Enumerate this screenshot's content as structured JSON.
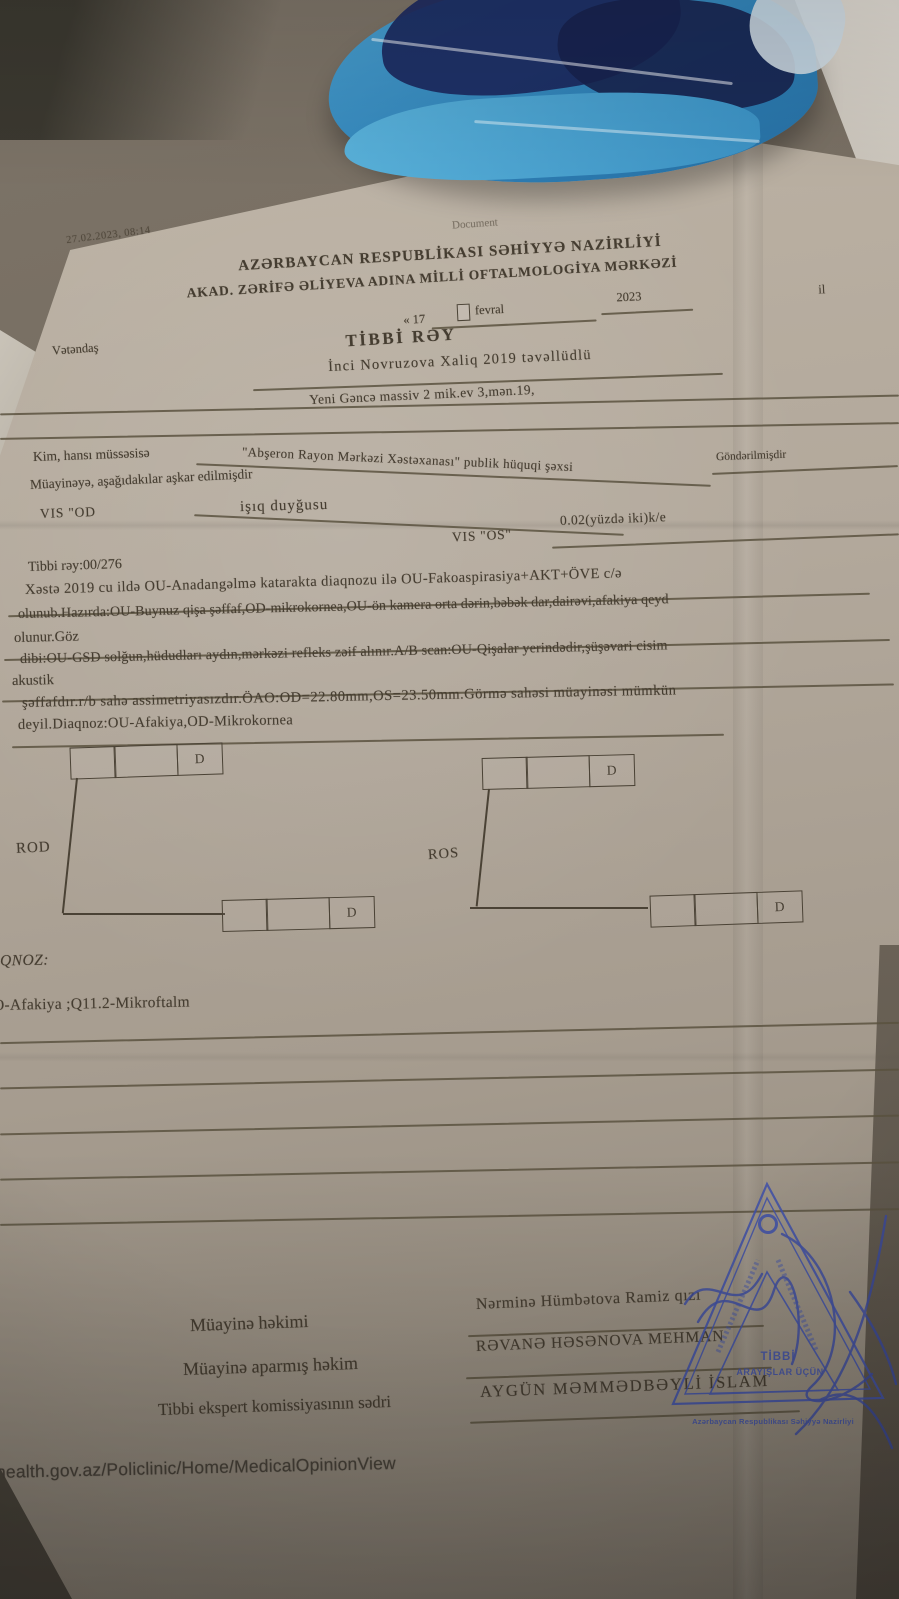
{
  "photo": {
    "timestamp": "27.02.2023, 08:14",
    "watermark": "Document",
    "footer_url": "health.gov.az/Policlinic/Home/MedicalOpinionView"
  },
  "header": {
    "ministry": "AZƏRBAYCAN RESPUBLİKASI SƏHİYYƏ NAZİRLİYİ",
    "center": "AKAD. ZƏRİFƏ ƏLİYEVA ADINA MİLLİ OFTALMOLOGİYA MƏRKƏZİ",
    "date": {
      "open": "« 17",
      "month": "fevral",
      "year": "2023",
      "suffix": "il"
    }
  },
  "title": "TİBBİ RƏY",
  "fields": {
    "citizen_label": "Vətəndaş",
    "citizen_value": "İnci Novruzova Xaliq 2019 təvəllüdlü",
    "address_value": "Yeni Gəncə massiv  2 mik.ev 3,mən.19,",
    "sender_label": "Kim, hansı müssəsisə",
    "sender_value": "\"Abşeron Rayon Mərkəzi Xəstəxanası\" publik hüquqi şəxsi",
    "sender_suffix": "Göndərilmişdir",
    "exam_intro": "Müayinəyə, aşağıdakılar aşkar edilmişdir",
    "vis_od_label": "VIS \"OD",
    "vis_od_value": "işıq duyğusu",
    "vis_os_label": "VIS \"OS\"",
    "vis_os_value": "0.02(yüzdə iki)k/e"
  },
  "report": {
    "ref": "Tibbi rəy:00/276",
    "lines": [
      "Xəstə 2019 cu ildə OU-Anadangəlmə katarakta  diaqnozu ilə OU-Fakoaspirasiya+AKT+ÖVE c/ə",
      "olunub.Hazırda:OU-Buynuz qişa şəffaf,OD-mikrokornea,OU-ön kamera orta dərin,bəbək dar,dairəvi,afakiya qeyd",
      "olunur.Göz",
      "dibi:OU-GSD solğun,hüdudları aydın,mərkəzi refleks zəif alınır.A/B scan:OU-Qişalar yerindədir,şüşəvari cisim",
      "akustik",
      "şəffafdır.r/b sahə assimetriyasızdır.ÖAO:OD=22.80mm,OS=23.50mm.Görmə sahəsi müayinəsi mümkün",
      "deyil.Diaqnoz:OU-Afakiya,OD-Mikrokornea"
    ]
  },
  "rx": {
    "rod_label": "ROD",
    "ros_label": "ROS",
    "d_label": "D"
  },
  "diagnosis": {
    "label": "QNOZ:",
    "value": "O-Afakiya ;Q11.2-Mikroftalm"
  },
  "signatures": {
    "rows": [
      {
        "label": "Müayinə həkimi",
        "value": "Nərminə Hümbətova Ramiz qızı"
      },
      {
        "label": "Müayinə aparmış həkim",
        "value": "RƏVANƏ HƏSƏNOVA MEHMAN"
      },
      {
        "label": "Tibbi ekspert komissiyasının sədri",
        "value": "AYGÜN MƏMMƏDBƏYLİ İSLAM"
      }
    ]
  },
  "stamp": {
    "line1": "TİBBİ",
    "line2": "ARAYIŞLAR ÜÇÜN",
    "footer": "Azərbaycan Respublikası Səhiyyə Nazirliyi"
  },
  "colors": {
    "stamp_blue": "#4253aa",
    "ink": "#453d31",
    "paper": "#b2a89b"
  }
}
